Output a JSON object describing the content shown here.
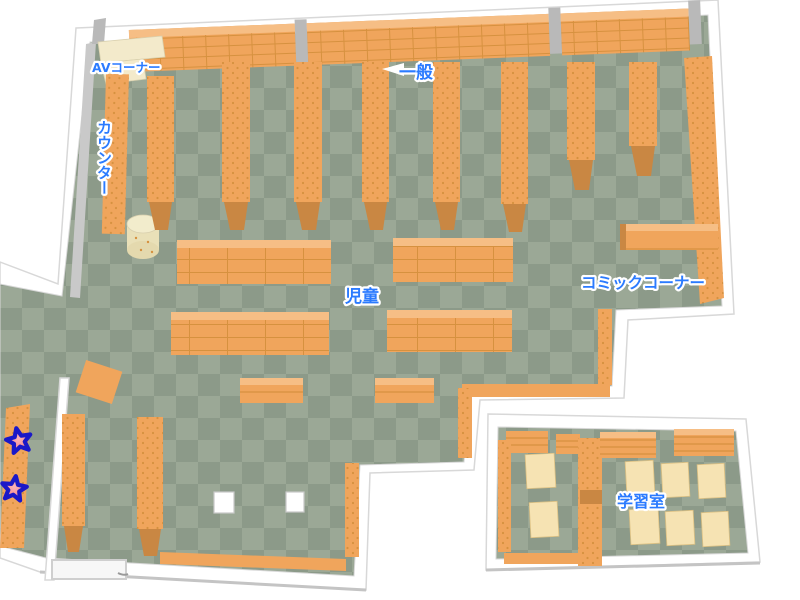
{
  "areas": {
    "av_corner": {
      "label": "AVコーナー"
    },
    "general": {
      "label": "一般"
    },
    "counter": {
      "label": "カウンター"
    },
    "children": {
      "label": "児童"
    },
    "comic_corner": {
      "label": "コミックコーナー"
    },
    "study_room": {
      "label": "学習室"
    }
  },
  "markers": {
    "stars": [
      {
        "icon": "star",
        "x": 19,
        "y": 441
      },
      {
        "icon": "star",
        "x": 14,
        "y": 489
      }
    ]
  },
  "colors": {
    "floor_light": "#9BA896",
    "floor_dark": "#8C9A89",
    "shelf": "#F0A55C",
    "shelf_dark": "#D6913F",
    "shelf_light": "#F6BE85",
    "shelf_foot": "#C98743",
    "wall_white": "#FFFFFF",
    "wall_edge": "#D8D8D8",
    "wall_gray": "#C9C9C9",
    "pillar_gray": "#B9B9B9",
    "cream": "#F3EACB",
    "desk": "#F6E3B3",
    "label_blue": "#2B7BFF",
    "star_fill": "#F2777C",
    "star_fill_light": "#FBB3B6",
    "star_stroke": "#1A18C8"
  }
}
